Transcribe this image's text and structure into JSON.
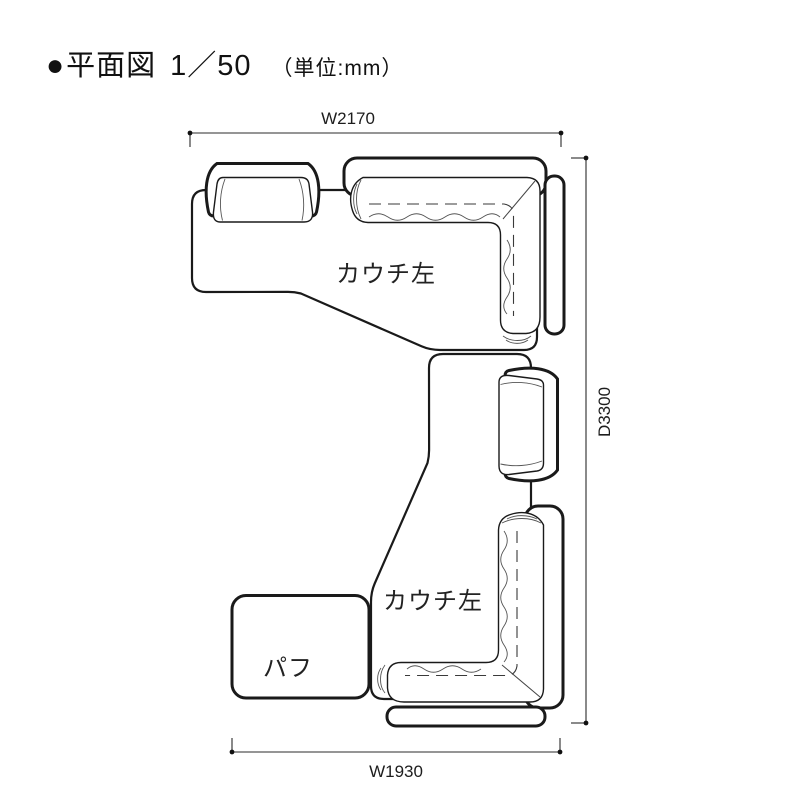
{
  "title": {
    "bullet": "●",
    "name": "平面図",
    "scale": "1／50",
    "unit_note": "（単位:mm）"
  },
  "dimensions": {
    "width_top": "W2170",
    "depth_right": "D3300",
    "width_bottom": "W1930"
  },
  "parts": {
    "upper_couch_label": "カウチ左",
    "lower_couch_label": "カウチ左",
    "pouf_label": "パフ"
  },
  "drawing": {
    "type": "floor-plan",
    "line_color": "#1a1a1a",
    "background_color": "#ffffff"
  }
}
